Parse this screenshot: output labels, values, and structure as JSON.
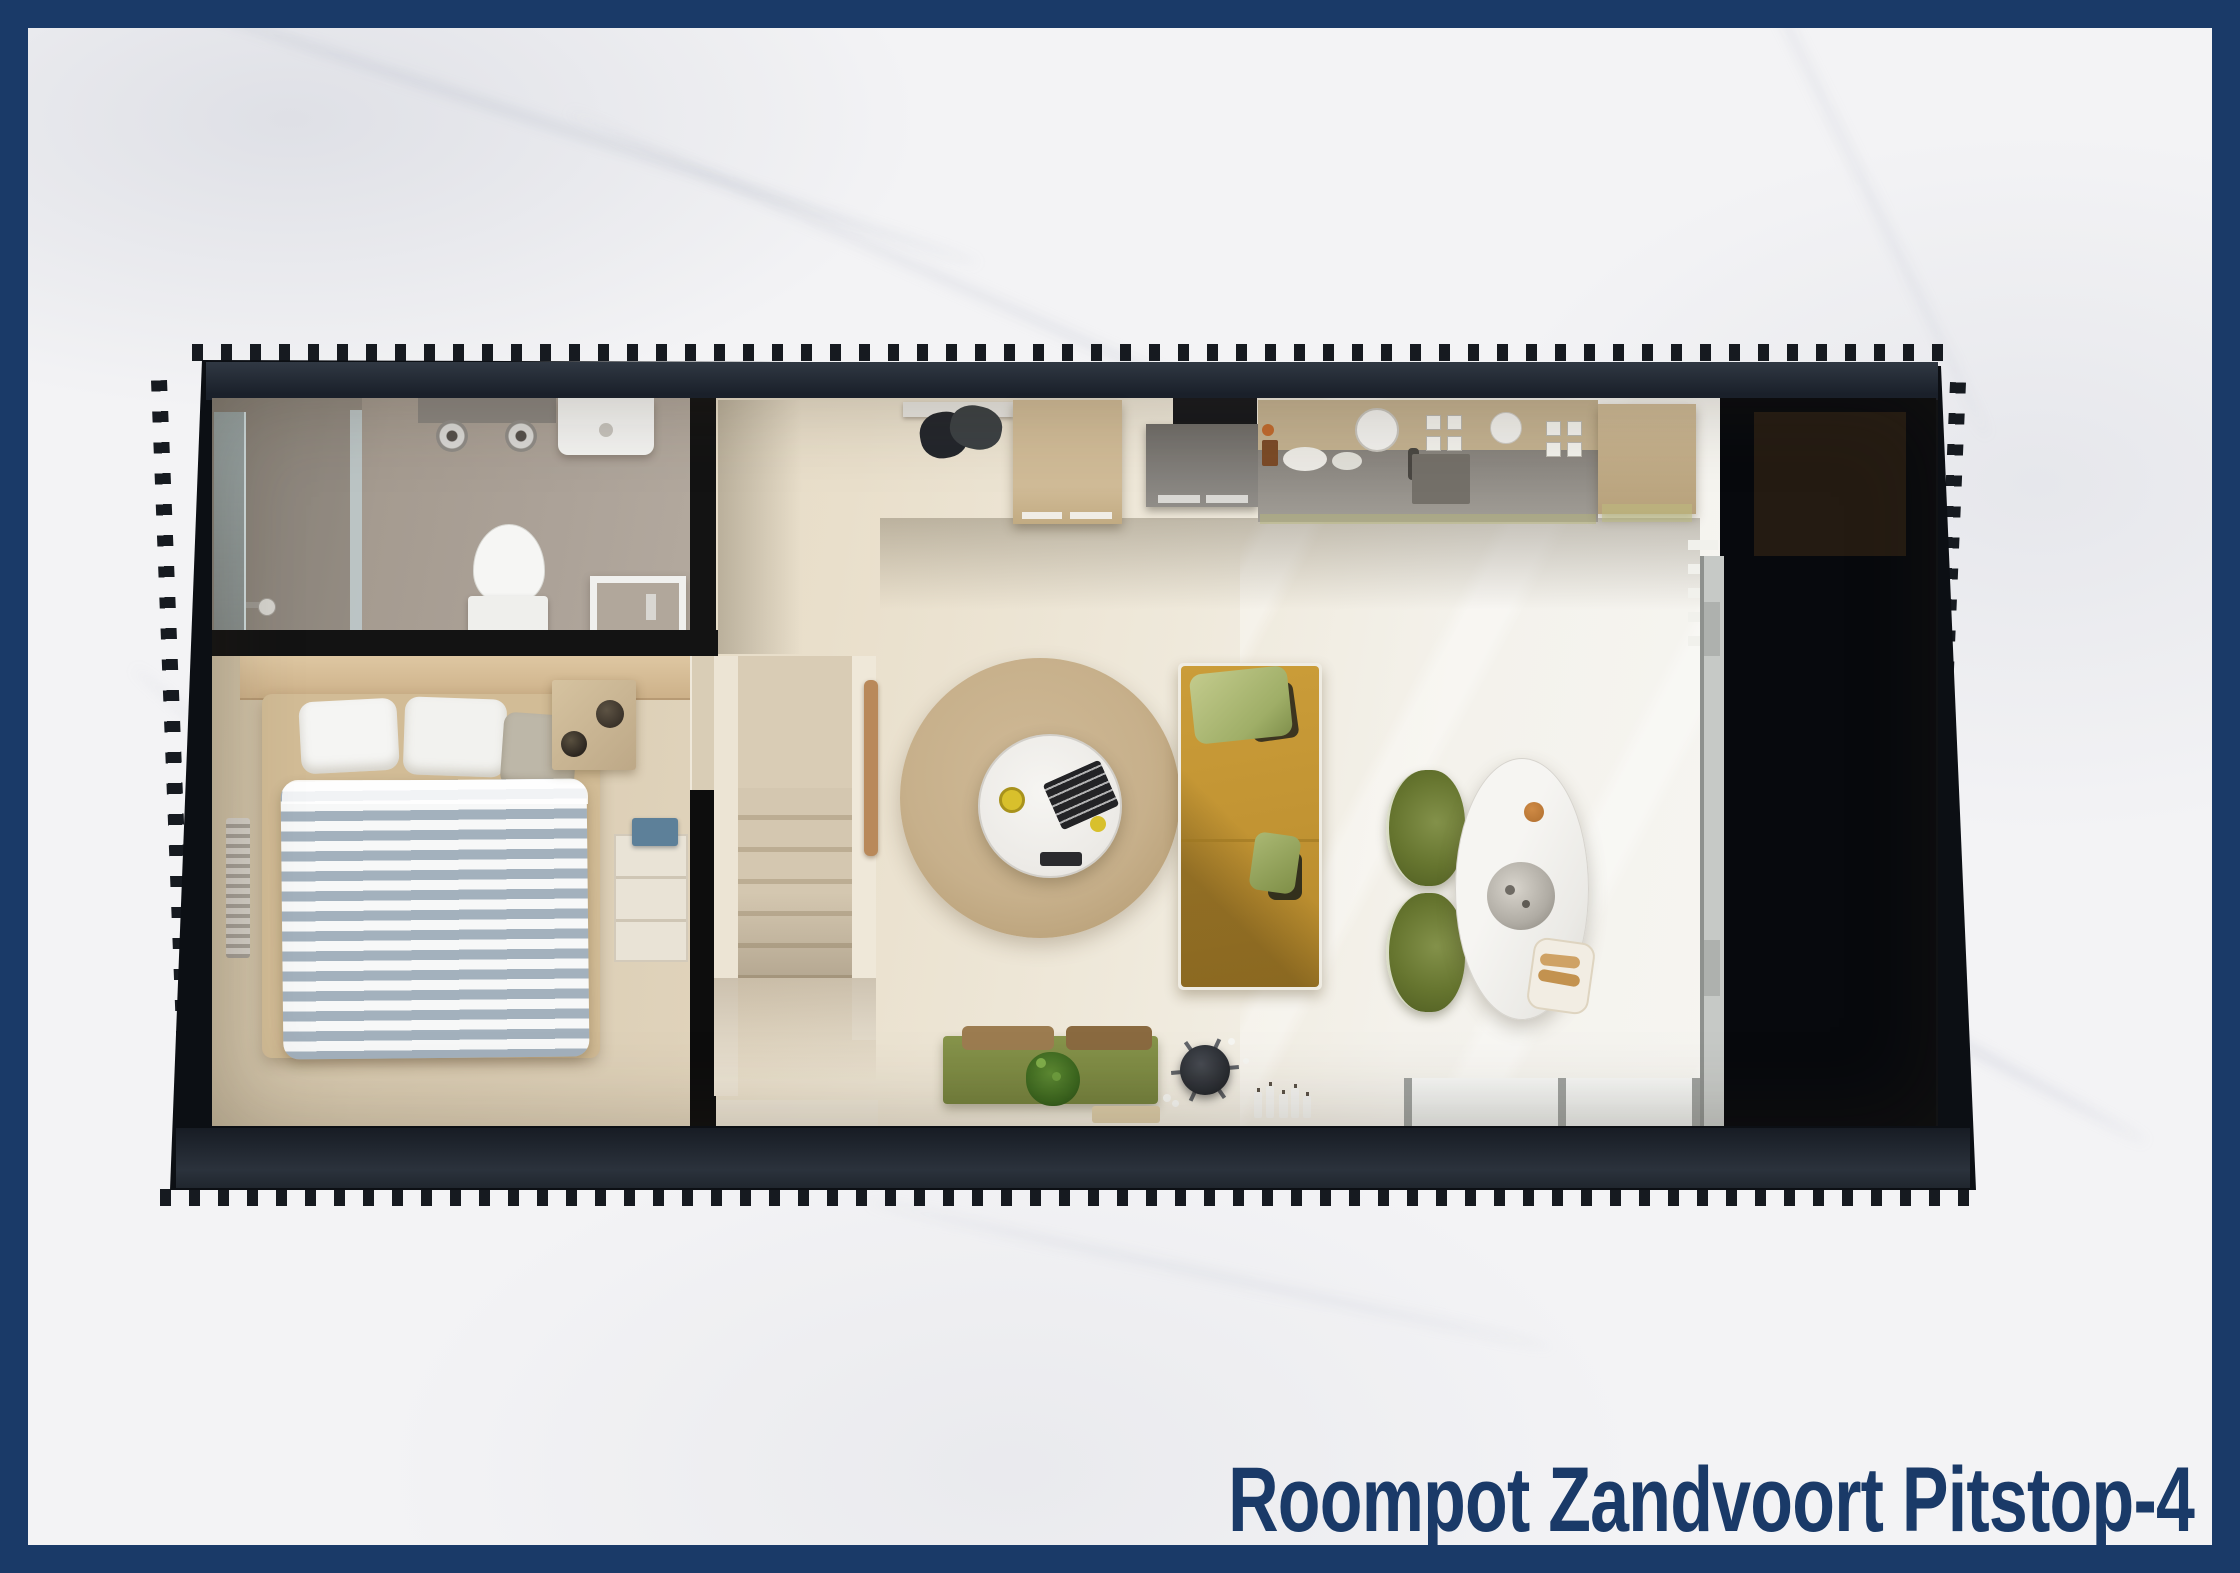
{
  "caption": {
    "text": "Roompot Zandvoort Pitstop-4",
    "color": "#1a3a68"
  },
  "palette": {
    "frame_navy": "#1a3a68",
    "marble_background": "#f3f3f5",
    "wall_black": "#0c0f14",
    "floor_cream": "#e7ddc7",
    "bathroom_floor_grey": "#a89e93",
    "bedroom_floor_beige": "#dacdb4",
    "rug_tan": "#c8b28e",
    "sofa_mustard": "#c29433",
    "chair_olive": "#66752f",
    "bench_green": "#7e8c44",
    "duvet_stripe_blue": "#a3b1bd",
    "terrace_black": "#07090d"
  },
  "floorplan": {
    "type": "top-down 3D rendered floor plan of a holiday home",
    "rooms": [
      {
        "name": "bathroom",
        "furniture": [
          "shower-glass",
          "shower-head",
          "mirror-with-spotlights",
          "washbasin",
          "toilet",
          "shower-tray"
        ]
      },
      {
        "name": "bedroom",
        "furniture": [
          "double-bed-striped-duvet",
          "pillows",
          "nightstand",
          "bedside-lamps",
          "wardrobe",
          "towel",
          "radiator"
        ]
      },
      {
        "name": "hallway",
        "furniture": [
          "staircase",
          "handrail",
          "coat-rack"
        ]
      },
      {
        "name": "kitchen",
        "furniture": [
          "tall-cabinet",
          "extractor-hood",
          "oven",
          "counter",
          "sink",
          "dishwasher",
          "stove-knobs",
          "dishes"
        ]
      },
      {
        "name": "living-room",
        "furniture": [
          "round-rug",
          "round-coffee-table",
          "magazines",
          "mug",
          "remote",
          "mustard-sofa",
          "green-cushions",
          "dining-table",
          "serving-bowl",
          "bread-basket",
          "dining-chairs",
          "green-sideboard-bench",
          "seat-cushions",
          "plant",
          "side-table-fan",
          "candles",
          "patio-window",
          "sliding-door"
        ]
      },
      {
        "name": "terrace",
        "furniture": [
          "dark-deck-panel"
        ]
      }
    ]
  }
}
